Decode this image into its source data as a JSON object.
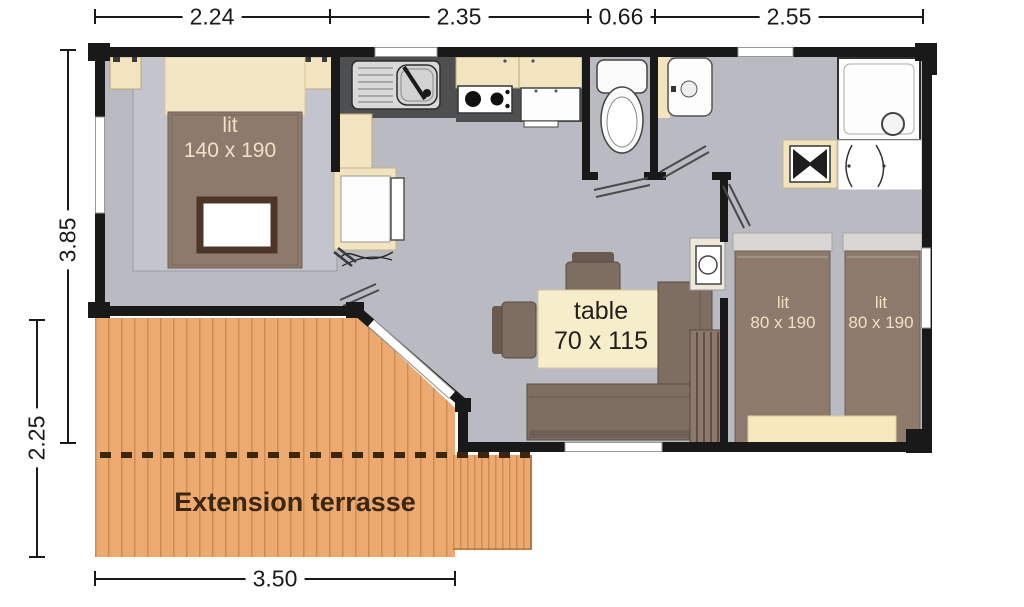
{
  "title": "Plan mobil-home avec terrasse",
  "colors": {
    "wall": "#191919",
    "floor": "#b9bac2",
    "terrace": "#edaa70",
    "cream": "#f2e4bf",
    "table_cream": "#f6edca",
    "furniture_brown": "#8d7a6d",
    "bench_brown": "#7e6d61",
    "counter_dark": "#4e4f51",
    "blanket_border": "#4e352a",
    "dim_text": "#1a1a1a",
    "terrace_text": "#3b2610",
    "bed_label_text": "#eee1c6",
    "table_label_text": "#241f1a"
  },
  "dimensions": {
    "top": [
      "2.24",
      "2.35",
      "0.66",
      "2.55"
    ],
    "left_building": "3.85",
    "left_terrace": "2.25",
    "bottom_terrace": "3.50"
  },
  "labels": {
    "master_bed_line1": "lit",
    "master_bed_line2": "140 x 190",
    "table_line1": "table",
    "table_line2": "70 x 115",
    "twin_bed_left_line1": "lit",
    "twin_bed_left_line2": "80 x 190",
    "twin_bed_right_line1": "lit",
    "twin_bed_right_line2": "80 x 190",
    "terrace": "Extension terrasse"
  },
  "fixtures": [
    "kitchen-sink",
    "gas-hob",
    "fridge",
    "upper-cabinets",
    "tall-cabinet",
    "toilet",
    "water-heater",
    "washbasin",
    "shower",
    "corner-washbasin",
    "wardrobe",
    "dining-table",
    "bench-seat",
    "chair",
    "double-bed",
    "single-bed"
  ]
}
